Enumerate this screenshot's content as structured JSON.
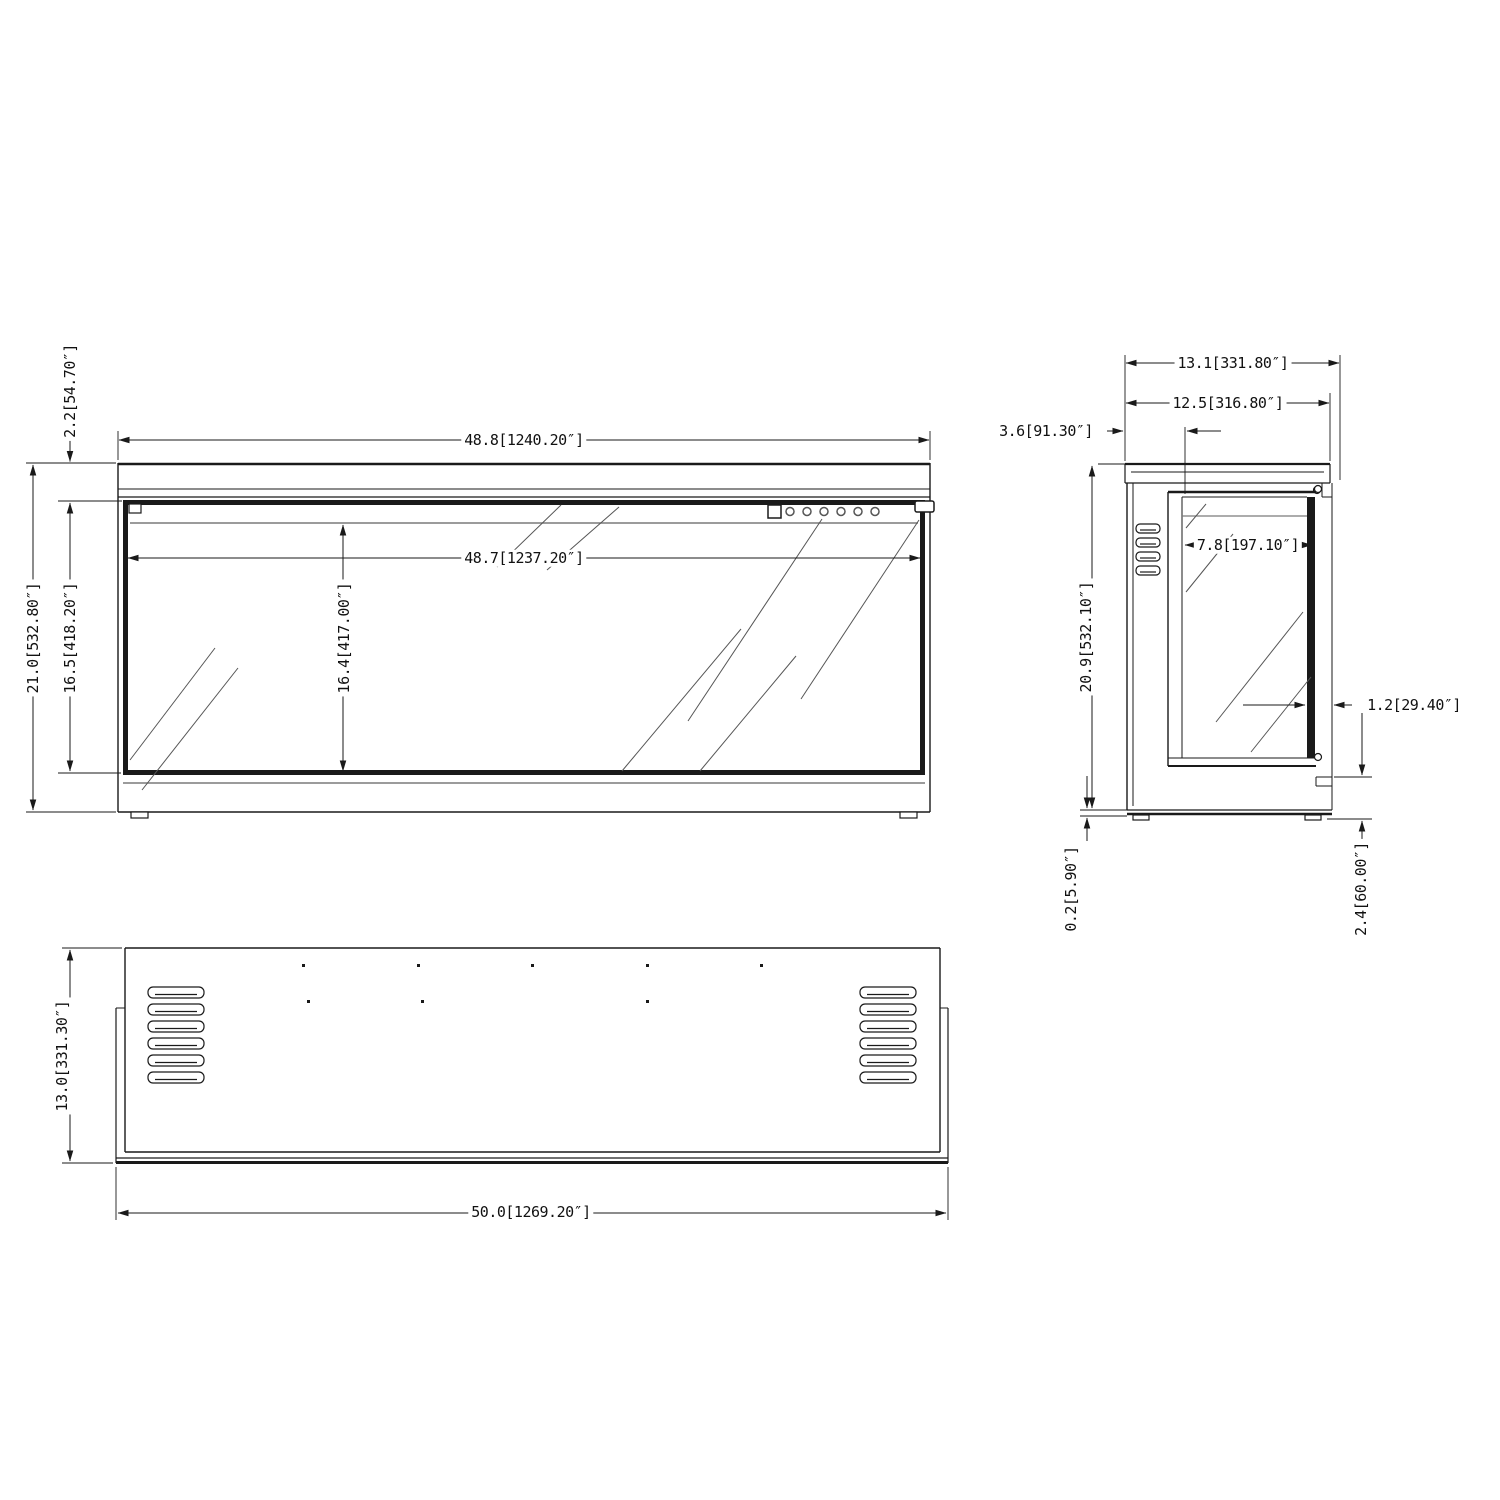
{
  "page": {
    "background": "#ffffff",
    "line_color": "#1a1a1a",
    "accent_gray": "#7a7a7a",
    "drawing_type": "3-view dimensional drawing of linear electric fireplace"
  },
  "views": {
    "front": {
      "dim_width_overall": "48.8[1240.20″]",
      "dim_width_glass": "48.7[1237.20″]",
      "dim_height_top_section": "2.2[54.70″]",
      "dim_height_overall": "21.0[532.80″]",
      "dim_height_front_panel": "16.5[418.20″]",
      "dim_height_glass": "16.4[417.00″]"
    },
    "side": {
      "dim_depth_overall": "13.1[331.80″]",
      "dim_depth_top": "12.5[316.80″]",
      "dim_depth_rear": "3.6[91.30″]",
      "dim_depth_glass": "7.8[197.10″]",
      "dim_height_overall": "20.9[532.10″]",
      "dim_glass_thickness": "1.2[29.40″]",
      "dim_bottom_plate": "0.2[5.90″]",
      "dim_bottom_front_gap": "2.4[60.00″]"
    },
    "bottom": {
      "dim_depth_overall": "13.0[331.30″]",
      "dim_width_overall": "50.0[1269.20″]"
    }
  }
}
